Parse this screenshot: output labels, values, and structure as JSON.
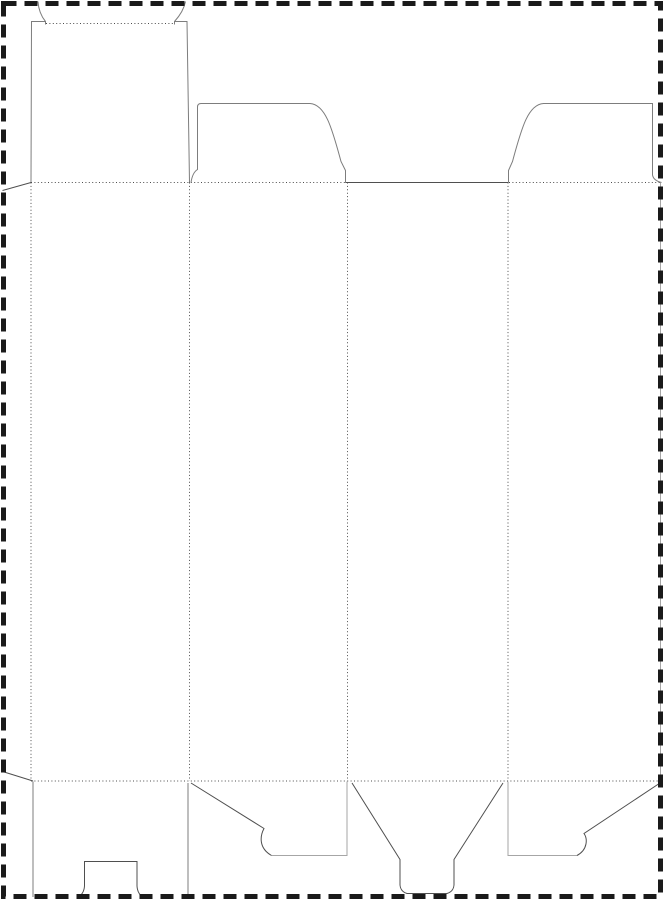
{
  "document": {
    "type": "packaging-dieline-template",
    "description": "tuck-top snap-lock-bottom folding carton dieline, no text labels visible"
  },
  "canvas": {
    "width": 664,
    "height": 900,
    "background": "#ffffff"
  },
  "page_border": {
    "x": 3.5,
    "y": 3.5,
    "width": 657,
    "height": 893,
    "color": "#1a1a1a",
    "stroke_width": 5,
    "dash": "13 8"
  },
  "styles": {
    "cut": "#7d7d7d",
    "cut_dark": "#4f4f4f",
    "cut_light": "#a6a6a6",
    "fold": "#4d4d4d",
    "fold_dash": "1 2.4",
    "stroke_width": 1
  },
  "cut_paths": [
    {
      "name": "lid-left-edge",
      "d": "M45.5,24.5 V21.5 H31.5 L31,182.5",
      "color": "cut"
    },
    {
      "name": "lid-right-edge",
      "d": "M174.5,24.5 V21.5 H187 L189.5,182.5",
      "color": "cut"
    },
    {
      "name": "tuck-left-shoulder",
      "d": "M45.5,21.5 C41,16 38.5,9 38,1.5",
      "color": "cut"
    },
    {
      "name": "tuck-right-shoulder",
      "d": "M174.5,21.5 C179.5,16 184,9 185.5,1.5",
      "color": "cut"
    },
    {
      "name": "top-dust-flap-left",
      "d": "M191,182.5 Q192.5,172.5 197.5,169.5 L197.5,107 Q197.5,103.5 201,103.5 L310,103.5 C325,104.5 331.5,126 341,161.5 L345.5,170.5 L345.5,182.5",
      "color": "cut"
    },
    {
      "name": "side-panel-top-cut",
      "d": "M345.5,182.5 H508.5",
      "color": "cut_dark"
    },
    {
      "name": "top-dust-flap-right",
      "d": "M508.5,182.5 L508.5,170.5 L512.5,161.5 C522,126 528.5,104.5 543.5,103.5 L652.5,103.5 L652.5,175 Q653.5,180.5 661.5,182.5",
      "color": "cut"
    },
    {
      "name": "right-panel-edge",
      "d": "M660.5,182.5 V781",
      "color": "cut_light"
    },
    {
      "name": "glue-flap-top-edge",
      "d": "M31,182.5 L2.5,190.5",
      "color": "cut_dark"
    },
    {
      "name": "glue-flap-bottom-edge",
      "d": "M2.5,771.5 L33,781",
      "color": "cut_dark"
    },
    {
      "name": "bottom-lock-flap-left-edge",
      "d": "M33,781.5 V897",
      "color": "cut"
    },
    {
      "name": "bottom-lock-flap-right-edge",
      "d": "M188,783 V897",
      "color": "cut"
    },
    {
      "name": "bottom-lock-flap-notch",
      "d": "M78,897 Q84,894 84.5,886 L84.5,861.5 L137,861.5 L137,886 Q137.5,894 143,897",
      "color": "cut_dark"
    },
    {
      "name": "bottom-dust-flap-left-cut",
      "d": "M191,783 L264,828.5 C260,836 258.5,848 271.5,855.5",
      "color": "cut_dark"
    },
    {
      "name": "bottom-dust-flap-left-edge",
      "d": "M271.5,855.5 L347,855.5 L347,781.5",
      "color": "cut_light"
    },
    {
      "name": "bottom-tuck-tongue",
      "d": "M352,783 L400,859.5 L400,885 Q400.5,891.5 407,893.5 L447,893.5 Q453.5,891.5 454,885 L454,859.5 L503,783",
      "color": "cut_dark"
    },
    {
      "name": "bottom-dust-flap-right-edge",
      "d": "M508,781.5 L508,855.5 L577,855.5",
      "color": "cut_light"
    },
    {
      "name": "bottom-dust-flap-right-cut",
      "d": "M577,855.5 C588,849.5 587.5,838.5 584,833.5 L661.5,782",
      "color": "cut_dark"
    }
  ],
  "fold_lines": [
    {
      "name": "tuck-fold",
      "x1": 46,
      "y1": 23.5,
      "x2": 174,
      "y2": 23.5
    },
    {
      "name": "top-fold-left",
      "x1": 31,
      "y1": 182.5,
      "x2": 345,
      "y2": 182.5
    },
    {
      "name": "top-fold-right",
      "x1": 509,
      "y1": 182.5,
      "x2": 660.5,
      "y2": 182.5
    },
    {
      "name": "bottom-fold",
      "x1": 31,
      "y1": 781,
      "x2": 661,
      "y2": 781
    },
    {
      "name": "glue-flap-fold",
      "x1": 31,
      "y1": 182.5,
      "x2": 31,
      "y2": 781
    },
    {
      "name": "panel-fold-1",
      "x1": 189.5,
      "y1": 182.5,
      "x2": 189.5,
      "y2": 781
    },
    {
      "name": "panel-fold-2",
      "x1": 347.5,
      "y1": 182.5,
      "x2": 347.5,
      "y2": 781
    },
    {
      "name": "panel-fold-3",
      "x1": 508,
      "y1": 182.5,
      "x2": 508,
      "y2": 781
    }
  ]
}
